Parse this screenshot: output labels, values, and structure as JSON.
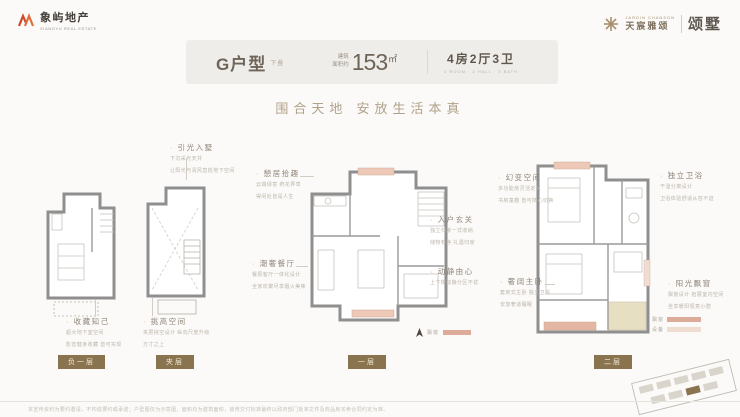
{
  "logo": {
    "cn": "象屿地产",
    "en": "XIANGYU REAL ESTATE"
  },
  "brand": {
    "en": "JARDIN CHANSON",
    "cn": "天宸雅颂",
    "product": "颂墅"
  },
  "header": {
    "unit": "G户型",
    "unit_tag": "下叠",
    "area_label_1": "建筑",
    "area_label_2": "面积约",
    "area_value": "153",
    "area_unit": "㎡",
    "rooms": "4房2厅3卫",
    "rooms_sub": "4 ROOM · 2 HALL · 3 BATH"
  },
  "slogan": "围合天地  安放生活本真",
  "annotations": {
    "light": {
      "title": "引光入墅",
      "line1": "下沉采光天井",
      "line2": "让阳光与清风直抵地下空间"
    },
    "collect": {
      "title": "收藏知己",
      "line1": "超大地下室空间",
      "line2": "影音健身收藏 皆可实现"
    },
    "loft": {
      "title": "挑高空间",
      "line1": "夹层挑空设计 纵向尺度升级",
      "line2": "方寸之上"
    },
    "leisure": {
      "title": "憩居拾趣",
      "line1": "云端绿意 莳花弄草",
      "line2": "得闲处皆是人生"
    },
    "dining": {
      "title": "潮奢餐厅",
      "line1": "餐厨客厅一体化设计",
      "line2": "全家欢聚尽享烟火美味"
    },
    "foyer": {
      "title": "入户玄关",
      "line1": "独立归家一式收纳",
      "line2": "储物有序 礼遇归家"
    },
    "zoning": {
      "title": "动静由心",
      "line1": "上下楼动静分区不扰"
    },
    "flex": {
      "title": "幻变空间",
      "line1": "多功能房灵活定义",
      "line2": "书房童趣 皆可随心切换"
    },
    "bath": {
      "title": "独立卫浴",
      "line1": "干湿分离设计",
      "line2": "卫浴体验舒适从容不迫"
    },
    "master": {
      "title": "奢阔主卧",
      "line1": "套房式主卧 独立卫浴",
      "line2": "安放奢适睡眠"
    },
    "bay": {
      "title": "阳光飘窗",
      "line1": "飘窗设计 拓展室内空间",
      "line2": "坐享暖阳惬意小憩"
    }
  },
  "floors": {
    "b1": "负一层",
    "mezz": "夹层",
    "f1": "一层",
    "f2": "二层"
  },
  "legend": {
    "f1_label": "飘窗",
    "f2_row1": "飘窗",
    "f2_row2": "设备"
  },
  "footer": {
    "disclaimer": "本宣传资料为要约邀请，不构成要约或承诺；户型图仅为示意图，面积均为建筑面积，装修交付标准最终以政府部门批准文件及商品房买卖合同约定为准。"
  },
  "colors": {
    "brand_orange": "#cf4a2b",
    "gold": "#a8906c",
    "badge_brown": "#8a734f",
    "window_pink": "#dcab9a",
    "window_pink_light": "#f0ddd2",
    "terrace_tan": "#e6dfc2"
  }
}
